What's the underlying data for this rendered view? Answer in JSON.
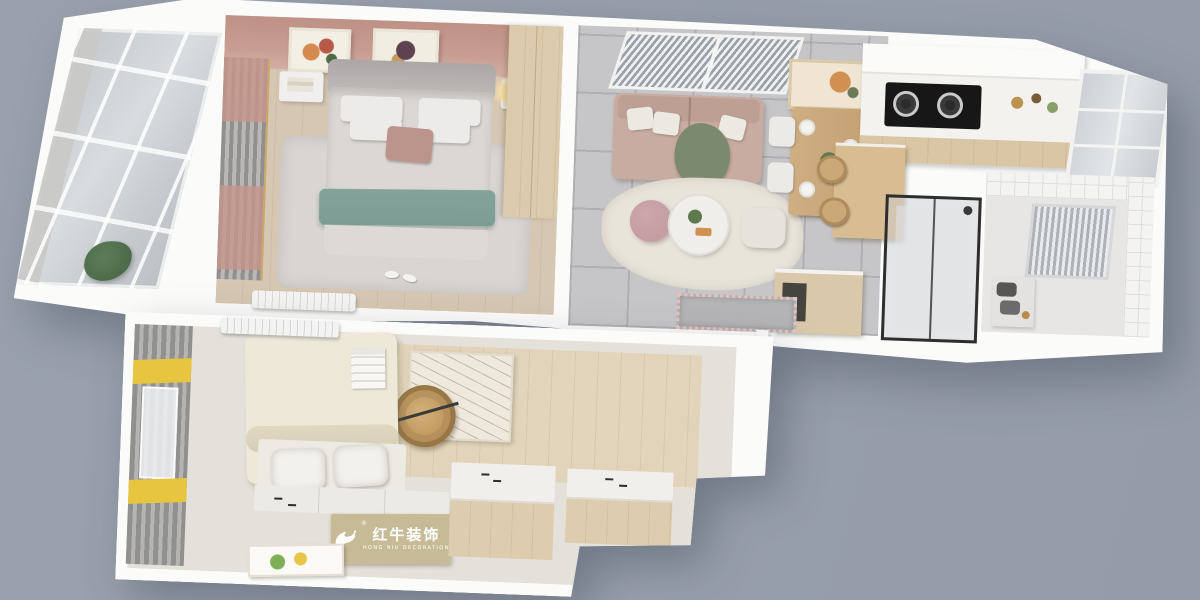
{
  "watermark": {
    "brand_cn": "红牛装饰",
    "brand_en": "HONG NIU DECORATION",
    "registered": "®"
  },
  "colors": {
    "bg": "#9aa1ad",
    "slab": "#fbfbfa",
    "wood-floor": "#d2c2ac",
    "wood-light": "#dfd0b6",
    "wood-cabinet": "#dac8aa",
    "tile": "#c6c6c8",
    "accent-wall": "#c79d92",
    "curtain-gray": "#90908e",
    "curtain-yellow": "#e8c53e",
    "teal-throw": "#7c9c94",
    "sofa-blush": "#c9aca1",
    "green-throw": "#7b8a6e",
    "rug-cream": "#e9e4da",
    "rug-gray": "#d8d5d2",
    "plant-green": "#4d6b4a",
    "frame-dark": "#2e2e2e",
    "cooktop-black": "#171717",
    "plaque-tan": "#c5b793",
    "pouf-pink": "#c29aa0"
  }
}
